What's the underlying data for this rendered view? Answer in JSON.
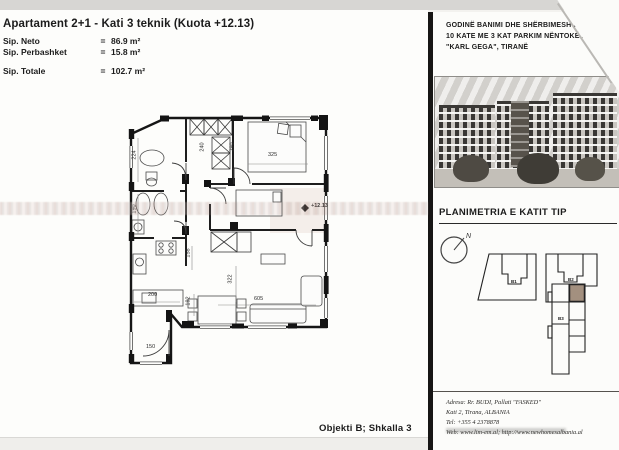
{
  "colors": {
    "ink": "#1c1c1c",
    "paper": "#fdfdfb",
    "scan_band": "#ba9288",
    "site_highlight": "#a3907f"
  },
  "title_block": {
    "title": "Apartament 2+1  - Kati 3 teknik (Kuota +12.13)",
    "rows": [
      {
        "label": "Sip. Neto",
        "eq": "=",
        "value": "86.9 m²"
      },
      {
        "label": "Sip. Perbashket",
        "eq": "=",
        "value": "15.8 m²"
      },
      {
        "label": "Sip. Totale",
        "eq": "=",
        "value": "102.7 m²"
      }
    ]
  },
  "plan": {
    "level_marker": "+12.13",
    "dimensions": [
      {
        "t": "224",
        "x": 12,
        "y": 48,
        "r": -90
      },
      {
        "t": "190",
        "x": 12,
        "y": 102,
        "r": -90
      },
      {
        "t": "240",
        "x": 80,
        "y": 40,
        "r": -90
      },
      {
        "t": "290",
        "x": 110,
        "y": 40,
        "r": -90
      },
      {
        "t": "325",
        "x": 150,
        "y": 48,
        "r": 0
      },
      {
        "t": "158",
        "x": 66,
        "y": 146,
        "r": -90
      },
      {
        "t": "322",
        "x": 108,
        "y": 172,
        "r": -90
      },
      {
        "t": "192",
        "x": 66,
        "y": 194,
        "r": -90
      },
      {
        "t": "200",
        "x": 30,
        "y": 188,
        "r": 0
      },
      {
        "t": "605",
        "x": 136,
        "y": 192,
        "r": 0
      },
      {
        "t": "150",
        "x": 28,
        "y": 240,
        "r": 0
      }
    ]
  },
  "footer_caption": "Objekti B; Shkalla 3",
  "right_panel": {
    "project_lines": [
      "GODINË BANIMI DHE SHËRBIMESH 2A",
      "10 KATE ME 3 KAT PARKIM NËNTOKË NË",
      "\"KARL GEGA\", TIRANË"
    ],
    "section_title": "PLANIMETRIA E KATIT TIP",
    "compass_label": "N",
    "buildings": [
      {
        "id": "B1"
      },
      {
        "id": "B2"
      },
      {
        "id": "B3"
      }
    ],
    "address_lines": [
      "Adresa: Rr. BUDI, Pallati \"FASKED\"",
      "Kati 2, Tirana, ALBANIA",
      "Tel: +355 4 2378878",
      "Web: www.lim-em.al;  http://www.newhomesalbania.al"
    ]
  }
}
